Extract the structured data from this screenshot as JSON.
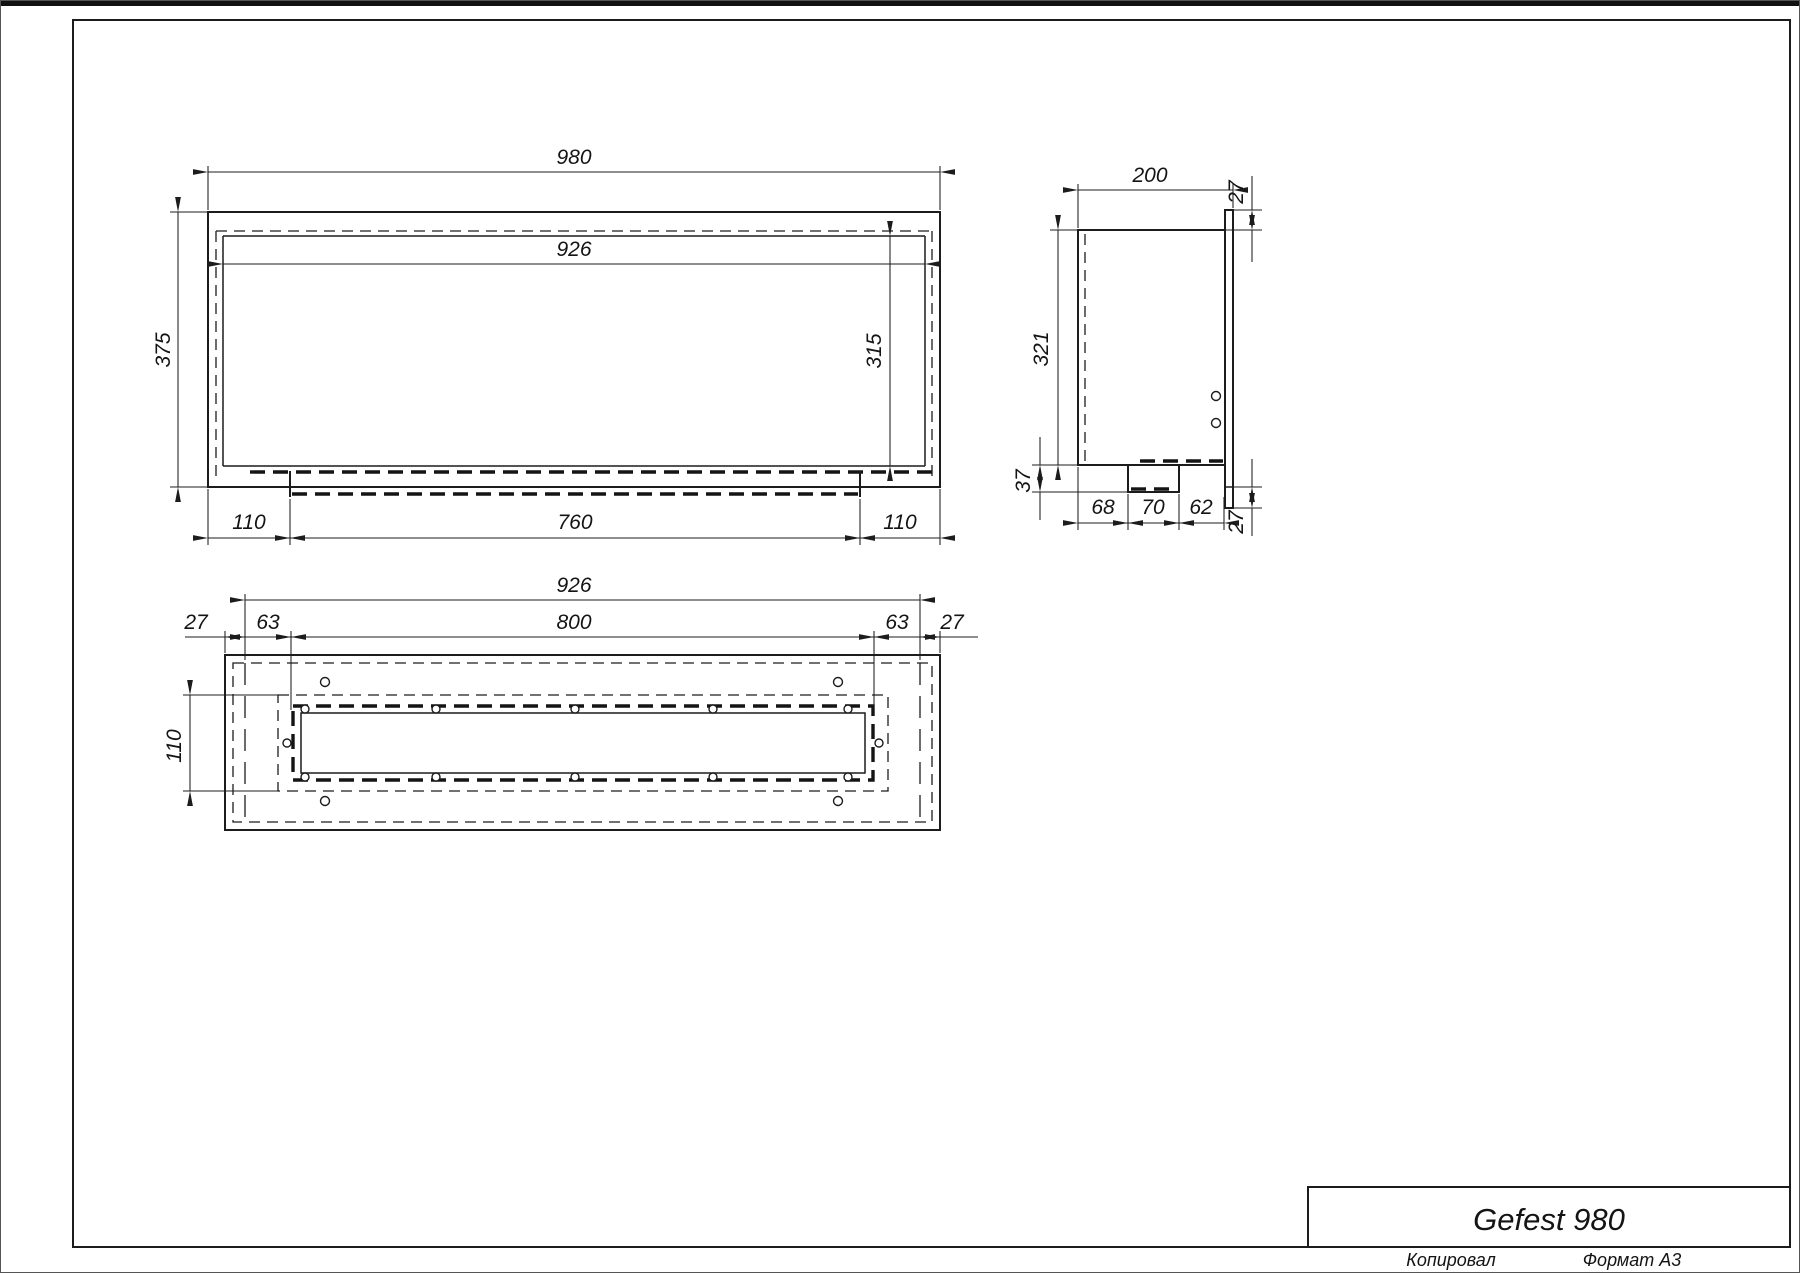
{
  "title_block": {
    "product": "Gefest 980"
  },
  "footer": {
    "copied_by": "Копировал",
    "format": "Формат А3"
  },
  "front_view": {
    "overall_width": "980",
    "inner_width": "926",
    "overall_height": "375",
    "inner_height": "315",
    "bottom_left_offset": "110",
    "tray_width": "760",
    "bottom_right_offset": "110"
  },
  "side_view": {
    "depth": "200",
    "flange_top": "27",
    "height": "321",
    "bottom_step": "37",
    "seg_left": "68",
    "seg_mid": "70",
    "seg_right": "62",
    "flange_bottom": "27"
  },
  "bottom_view": {
    "inner_width": "926",
    "mount_width": "800",
    "left_edge": "27",
    "left_wall": "63",
    "right_wall": "63",
    "right_edge": "27",
    "slot_height": "110"
  }
}
